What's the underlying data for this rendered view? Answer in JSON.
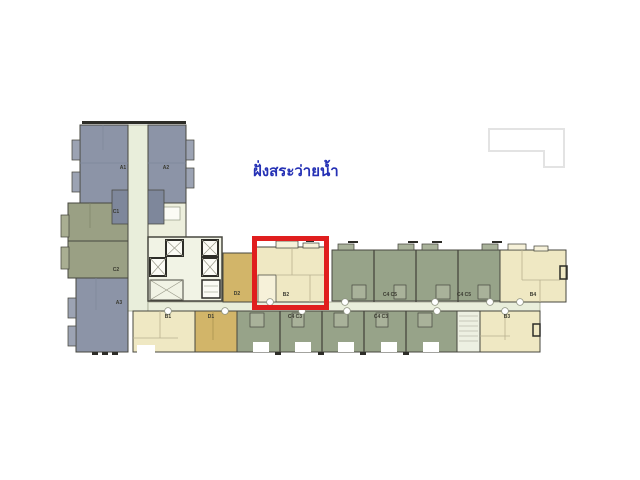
{
  "annotation": {
    "text": "ฝั่งสระว่ายน้ำ",
    "color": "#2531b5"
  },
  "highlight_box": {
    "color": "#e01e1e",
    "highlighted_unit": "B2"
  },
  "adjacent_building_outline": {
    "color": "#e3e3e3"
  },
  "palette": {
    "white": "#ffffff",
    "blue": "#8c94a7",
    "blueLight": "#9ca3b3",
    "blueDark": "#7e879b",
    "olive": "#9aa084",
    "oliveLight": "#a9ae92",
    "sage": "#97a389",
    "sageLight": "#a9b29a",
    "cream": "#efe8c3",
    "creamLight": "#f6f1d9",
    "tan": "#d2b569",
    "corridor": "#e9eedb",
    "coreFloor": "#f1f3e5",
    "shaftWhite": "#fbfbf5",
    "lobby": "#edefdd",
    "stair": "#edf0e2",
    "wall": "#47473f",
    "wallDark": "#2d2d28",
    "detail": "#9aa08b",
    "label": "#3a3a30"
  },
  "plan": {
    "unit_labels": {
      "a1": "A1",
      "a2": "A2",
      "c1": "C1",
      "c2": "C2",
      "a3": "A3",
      "d2": "D2",
      "b2": "B2",
      "b1": "B1",
      "d1": "D1",
      "b3": "B3",
      "b4": "B4",
      "c4c5": "C4 C5",
      "c4c3": "C4 C3"
    }
  }
}
